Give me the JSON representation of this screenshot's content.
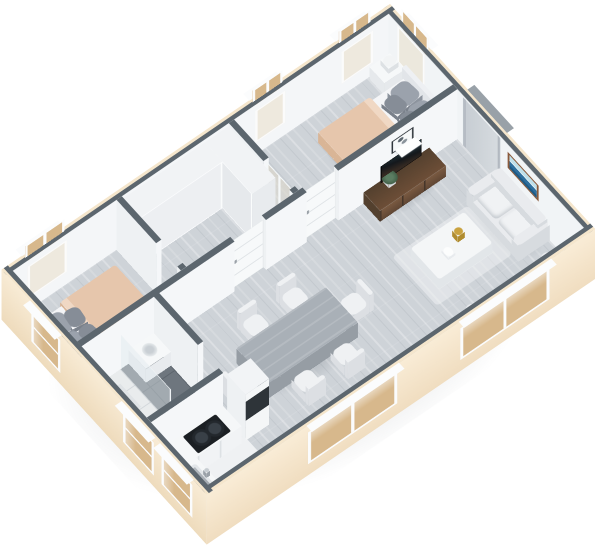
{
  "meta": {
    "kind": "3d-isometric-floorplan-render",
    "visible_text": [],
    "view": {
      "tilt_deg": 30,
      "rotation_deg": 51.7,
      "wall_height_units": 100,
      "plan_units": [
        331,
        495
      ]
    }
  },
  "colors": {
    "walltop": "#5c666e",
    "wallin": "#f4f6f8",
    "wallshade": "#eef1f3",
    "cream": "#f5e6cc",
    "creamd": "#efdcbd",
    "framew": "#fbfcfd",
    "tan": "#d7b88c",
    "wood": "#ced3d8",
    "marble": "#eff1f3",
    "tile": "#6e767e",
    "grout": "#5d656d",
    "shower": "#e9eced",
    "doorw": "#f7f9fa",
    "walnut": "#6d4e37",
    "walnutd": "#53402e",
    "tv": "#14181c",
    "blanket": "#e6c6ac",
    "blanketd": "#d9b596",
    "sheet": "#f4f5f7",
    "pillow": "#9ba2ac",
    "pillowd": "#868d97",
    "sofa": "#e9ebee",
    "sofad": "#d7dbdf",
    "teal": "#41687a",
    "tanp": "#a8977f",
    "tablec": "#a9b0b7",
    "chairc": "#eff1f3",
    "gold": "#c9a23f",
    "plant": "#45624b",
    "pot": "#3c4248",
    "artblue": "#2e6f9e",
    "frameb": "#8a5a3b",
    "steel": "#9aa1a8",
    "glass": "rgba(225,232,238,.45)"
  },
  "scene": {
    "rooms": [
      {
        "name": "bedroom-top",
        "floor": "light-gray-wood"
      },
      {
        "name": "walk-in-closet",
        "floor": "light-gray-wood"
      },
      {
        "name": "bedroom-left",
        "floor": "light-gray-wood"
      },
      {
        "name": "bathroom",
        "floor": "dark-gray-tile-with-white-shower"
      },
      {
        "name": "kitchen",
        "floor": "white-marble"
      },
      {
        "name": "living-dining-room",
        "floor": "light-gray-wood"
      }
    ],
    "furniture": [
      "double-bed-top",
      "nightstand",
      "table-lamp",
      "double-bed-left",
      "wardrobe-run-long",
      "wardrobe-run-short",
      "glass-door-closet",
      "interior-door-bedroom",
      "interior-door-closet",
      "entry-door",
      "sofa-north",
      "sofa-east",
      "coffee-table",
      "gold-decor",
      "area-rug",
      "tv-console",
      "tv-screen",
      "wall-shelf",
      "wall-art-ocean",
      "corner-plant",
      "dining-table",
      "dining-chairs-x6",
      "kitchen-counter-cooktop",
      "kitchen-counter-sink",
      "fridge-tall-unit",
      "toilet",
      "bath-vanity",
      "shower-glass",
      "shower-drain"
    ],
    "windows": [
      "window-ne-bedroom-top",
      "window-nw-bedroom-top-1",
      "window-nw-bedroom-top-2",
      "window-nw-bedroom-left",
      "window-se-living-1",
      "window-se-living-2",
      "window-sw-bedroom-left",
      "window-sw-kitchen-1",
      "window-sw-kitchen-2"
    ]
  }
}
